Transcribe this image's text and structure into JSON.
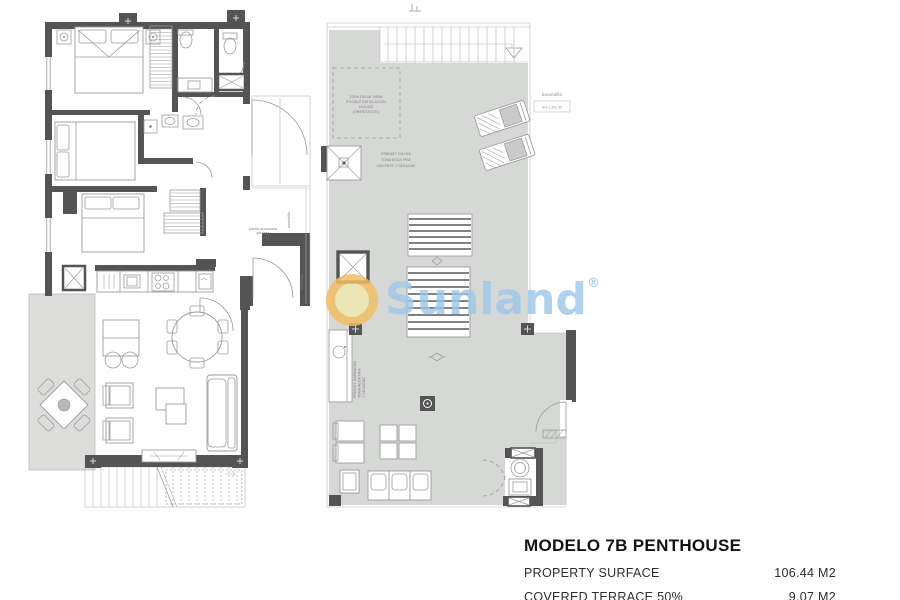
{
  "colors": {
    "wall": "#545454",
    "line": "#9a9a9a",
    "terrace_fill": "#dcdddb",
    "solarium_fill": "#d6d8d6",
    "watermark_blue": "#9ec7e7",
    "logo_ring": "#f0a63e",
    "logo_fill": "#f7eca3"
  },
  "watermark": {
    "brand": "Sunland",
    "registered": "®"
  },
  "apartment_plan": {
    "labels": {
      "railing_upper": "barandilla",
      "railing_lower": "barandilla",
      "entry_line1": "puerta acorazada",
      "entry_line2": "gardesa"
    }
  },
  "solarium_plan": {
    "labels": {
      "railing": "barandilla",
      "ac_unit": "A/A 1.30x.35",
      "shower_note": [
        "PREINST. DUCHA",
        "TOMA AGUA FRIA",
        "CALIENTE Y DESAGÜE"
      ],
      "zone_note": [
        "ZONA DELIM. PARA",
        "POSIBLE INSTALACION",
        "JACUZZI",
        "(ORIENTATIVO)"
      ],
      "bbq_note": [
        "PREINST. BARBACOA",
        "TOMA AGUA FRIA",
        "Y DESAGUE"
      ]
    }
  },
  "title_block": {
    "title": "MODELO 7B PENTHOUSE",
    "rows": [
      {
        "label": "PROPERTY SURFACE",
        "value": "106.44 M2"
      },
      {
        "label": "COVERED TERRACE 50%",
        "value": "9.07 M2"
      }
    ]
  }
}
